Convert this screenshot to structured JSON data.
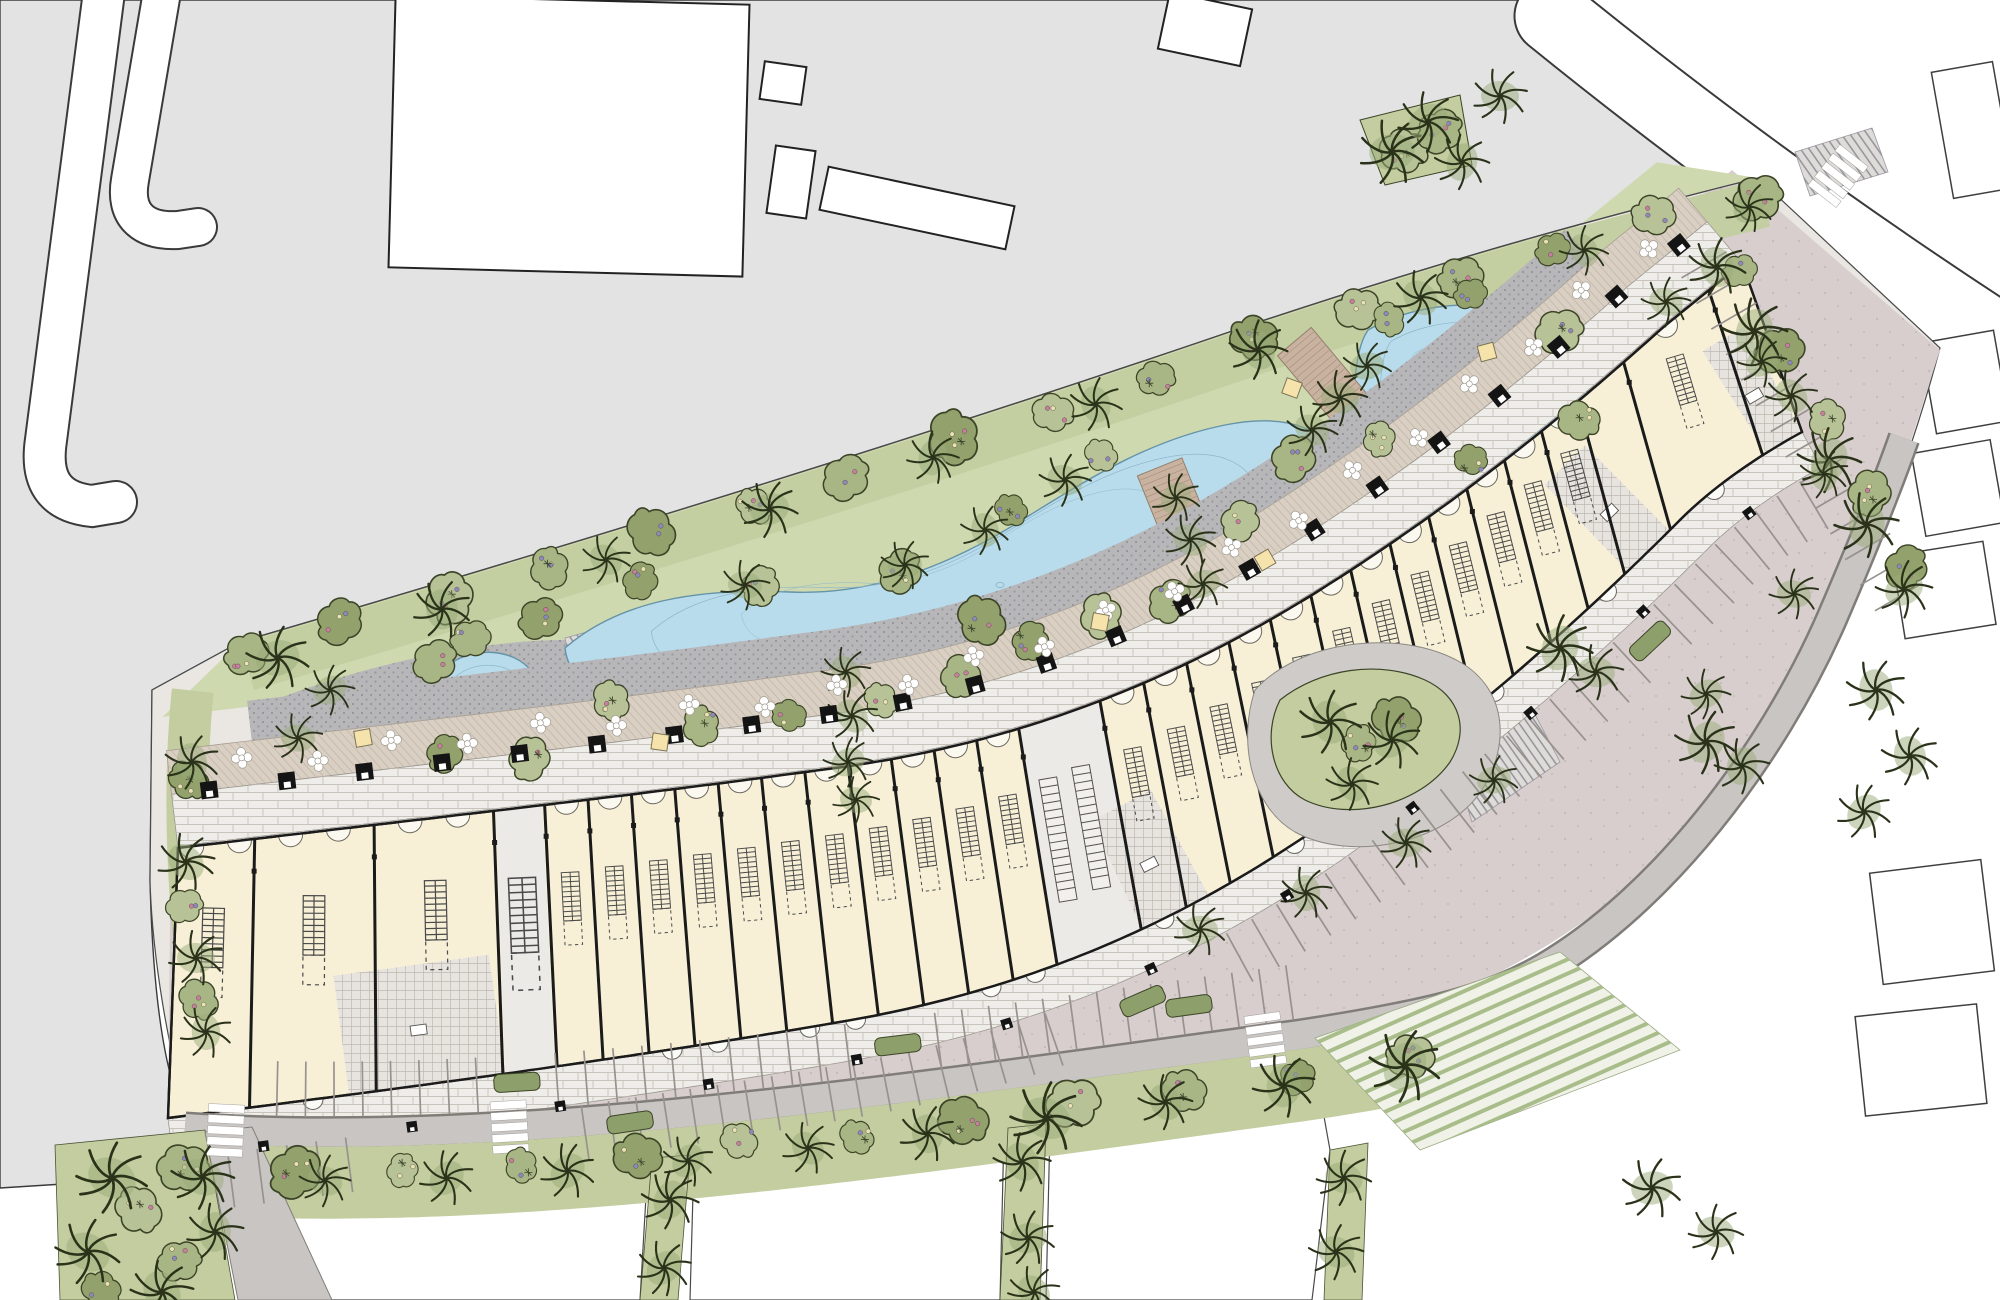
{
  "drawing": {
    "kind": "landscape-masterplan-site-plan",
    "visible_text": []
  },
  "palette": {
    "context_gray": "#e3e3e4",
    "context_stroke": "#3a3a3a",
    "site_base": "#eae7e3",
    "site_stroke": "#4a4a4a",
    "lawn": "#cfd9b0",
    "band_green": "#c2cda0",
    "strip_green": "#c3cd9f",
    "bush_greens": [
      "#a8b584",
      "#93a26d",
      "#b7c297"
    ],
    "palm_stroke": "#2a3219",
    "water": "#b8dcec",
    "water_edge": "#6593a7",
    "water_contour": "#8fb7c9",
    "playground_pink": "#e3bdb9",
    "play_stroke": "#8a8684",
    "promenade": "#efede9",
    "flower_walk": "#d9cfc3",
    "cobble": "#b7b6b8",
    "boardwalk": "#c9b3a0",
    "plank": "#927e6a",
    "building_fill": "#f7f0d7",
    "building_wall": "#1b1b1b",
    "core_fill": "#e7e4df",
    "breeze_fill": "#eceae6",
    "parking": "#d7cecd",
    "stall_line": "#98928e",
    "road_band": "#c8c5c3",
    "road_edge": "#807d79",
    "island_green": "#8da06b",
    "bench_black": "#141414",
    "seat_yellow": "#f5e3ab",
    "flower_pink": "#c77f9f",
    "flower_purple": "#8d89bd",
    "flower_cream": "#e9e2b5",
    "turf_stripe": "#a9bd8a",
    "hatch_gray": "#8f8c96"
  },
  "guides": {
    "front": "M178,848 C430,818 640,795 820,770 C1000,748 1160,690 1320,590 C1450,508 1560,420 1660,330 C1700,297 1722,280 1742,263",
    "back": "M168,1118 C430,1085 650,1055 840,1022 C1030,990 1190,920 1340,812 C1470,718 1580,620 1680,520 C1715,485 1760,455 1802,432",
    "tb": "M240,642 C520,560 900,445 1250,325 C1460,255 1610,215 1758,178",
    "bb": "M185,1128 C500,1150 900,1090 1300,1035 C1430,1015 1490,1000 1545,968 C1660,900 1770,760 1832,618 C1872,525 1892,472 1904,438",
    "wl": "M168,688 C158,780 160,920 186,1060",
    "buffer": "M1722,240 L1930,598"
  },
  "context": {
    "gray_poly": "M0,0 L1518,0 C1560,35 1640,105 1706,150 L1758,178 C1610,215 1460,255 1250,325 C900,445 520,560 240,642 L152,690 L150,880 C153,1005 166,1086 190,1126 L95,1182 L0,1188 Z",
    "roads": [
      {
        "d": "M104,-8 L46,440 C40,480 54,502 92,506 L116,502",
        "w": 40
      },
      {
        "d": "M162,-8 L130,180 C124,214 142,232 178,230 L198,227",
        "w": 36
      },
      {
        "d": "M1552,16 C1690,128 1840,238 2010,348",
        "w": 73
      }
    ],
    "buildings": [
      {
        "x": 392,
        "y": 0,
        "w": 354,
        "h": 272,
        "rot": 1.5
      },
      {
        "x": 762,
        "y": 64,
        "w": 42,
        "h": 38,
        "rot": 8
      },
      {
        "x": 771,
        "y": 148,
        "w": 40,
        "h": 68,
        "rot": 8
      },
      {
        "x": 822,
        "y": 186,
        "w": 190,
        "h": 44,
        "rot": 12
      },
      {
        "x": 1163,
        "y": 0,
        "w": 84,
        "h": 58,
        "rot": 12
      }
    ],
    "parcels": [
      {
        "x": 1942,
        "y": 66,
        "w": 62,
        "h": 128,
        "rot": -10
      },
      {
        "x": 1928,
        "y": 336,
        "w": 74,
        "h": 92,
        "rot": -10
      },
      {
        "x": 1918,
        "y": 446,
        "w": 80,
        "h": 84,
        "rot": -10
      },
      {
        "x": 1898,
        "y": 548,
        "w": 92,
        "h": 84,
        "rot": -9
      },
      {
        "x": 1876,
        "y": 866,
        "w": 112,
        "h": 112,
        "rot": -7
      },
      {
        "x": 1860,
        "y": 1010,
        "w": 122,
        "h": 100,
        "rot": -6
      }
    ],
    "bottom_parcels": [
      "M238,1192 L648,1162 L640,1300 L242,1300 Z",
      "M694,1158 L1004,1132 L1000,1300 L690,1300 Z",
      "M1050,1128 L1316,1072 L1330,1150 L1312,1300 L1046,1300 Z"
    ]
  },
  "site": {
    "base_poly": "M240,642 C520,560 900,445 1250,325 C1460,255 1610,215 1758,178 L1940,348 C1908,468 1862,588 1792,702 C1700,822 1562,940 1432,1000 C1210,1062 700,1137 190,1128 C168,1050 152,955 150,880 L152,690 Z",
    "parking_poly": "M168,1122 C500,1145 900,1088 1300,1038 C1470,1008 1598,928 1702,818 C1790,702 1862,586 1902,468 L1940,350 L1732,170 C1640,250 1540,322 1448,408 C1330,520 1190,640 1020,730 C840,812 520,862 300,880 C220,888 180,900 170,920 Z",
    "cobble_plazas": [
      "M262,705 C360,665 480,640 565,640 L605,715 C520,790 400,800 300,802 Z",
      "M1245,565 C1290,480 1380,420 1480,418 C1520,470 1515,545 1470,600 C1400,650 1300,640 1245,565 Z"
    ],
    "hatch_wedges": [
      "M565,638 L660,612 L648,692 L578,702 Z",
      "M1470,600 L1542,560 L1562,622 L1492,656 Z",
      "M1445,735 L1530,705 L1560,762 L1472,822 Z",
      "M1795,152 L1872,128 L1888,172 L1810,196 Z"
    ],
    "turf_poly": "M1315,1038 L1560,952 L1680,1050 L1420,1150 Z",
    "teardrop_ring": "M1255,690 C1300,640 1400,628 1460,662 C1505,688 1512,742 1482,790 C1445,845 1350,862 1295,832 C1250,806 1238,740 1255,690 Z",
    "teardrop_green": "M1280,700 C1320,668 1380,660 1425,680 C1460,696 1470,730 1450,762 C1420,805 1350,822 1305,800 C1272,783 1262,735 1280,700 Z",
    "median_green": "M1360,120 L1460,95 L1472,165 L1385,185 Z",
    "strip_verticals": [
      "M652,1158 L690,1155 L678,1300 L640,1300 Z",
      "M1008,1128 L1046,1124 L1040,1300 L1000,1300 Z",
      "M1330,1150 L1368,1143 L1362,1300 L1324,1300 Z"
    ],
    "corner_green": "M55,1145 L205,1130 L235,1300 L60,1300 Z",
    "corner_road": "M205,1132 L252,1127 L332,1300 L238,1300 Z"
  },
  "building": {
    "divider_segments": [
      {
        "from": 0.045,
        "to": 0.185,
        "n": 3,
        "big": true
      },
      {
        "from": 0.215,
        "to": 0.495,
        "n": 12,
        "big": false
      },
      {
        "from": 0.545,
        "to": 0.875,
        "n": 13,
        "big": false
      },
      {
        "from": 0.91,
        "to": 0.975,
        "n": 2,
        "big": false
      }
    ],
    "cores": [
      [
        0.1,
        0.185
      ],
      [
        0.545,
        0.585
      ],
      [
        0.875,
        0.91
      ],
      [
        0.975,
        1.0
      ]
    ],
    "breezeways": [
      [
        0.185,
        0.215
      ],
      [
        0.495,
        0.545
      ]
    ]
  },
  "promenade": {
    "bench_count": 22,
    "flower_count": 22,
    "south_bench_count": 12
  },
  "ponds": [
    {
      "d": "M445,668 C470,645 515,648 532,672 C548,695 545,730 528,752 C505,778 468,775 452,752 C436,730 430,690 445,668 Z",
      "bubbles": [
        [
          480,
          705,
          4
        ],
        [
          505,
          735,
          2.5
        ]
      ]
    },
    {
      "d": "M565,648 C620,600 700,588 790,592 C880,596 960,560 1030,515 C1090,478 1150,440 1225,425 C1290,412 1330,430 1345,470 C1358,505 1340,545 1300,560 C1250,578 1190,570 1130,595 C1070,620 1010,660 940,690 C860,723 760,730 680,718 C615,708 570,690 565,648 Z",
      "bubbles": [
        [
          700,
          650,
          4
        ],
        [
          850,
          655,
          3
        ],
        [
          1000,
          585,
          4
        ],
        [
          1160,
          520,
          3
        ],
        [
          1280,
          490,
          4
        ]
      ]
    },
    {
      "d": "M1368,330 C1420,300 1500,295 1555,325 C1590,345 1598,390 1575,425 C1548,462 1480,465 1425,452 C1380,442 1352,415 1355,380 C1357,358 1360,342 1368,330 Z",
      "bubbles": [
        [
          1470,
          380,
          4
        ],
        [
          1520,
          350,
          2.5
        ]
      ]
    }
  ],
  "bridges": [
    {
      "x": 851,
      "y": 737,
      "w": 52,
      "h": 178,
      "rot": 7
    },
    {
      "x": 1190,
      "y": 542,
      "w": 48,
      "h": 162,
      "rot": -22
    },
    {
      "x": 1340,
      "y": 396,
      "w": 44,
      "h": 142,
      "rot": -40
    }
  ],
  "decks": [
    {
      "x": 702,
      "y": 726,
      "w": 54,
      "h": 64,
      "rot": -16
    },
    {
      "x": 1126,
      "y": 638,
      "w": 60,
      "h": 72,
      "rot": -34
    }
  ],
  "playground": {
    "cx": 1345,
    "cy": 495,
    "rx": 100,
    "ry": 62,
    "rot": -33
  },
  "parking_rows": [
    {
      "guide": "back",
      "ranges": [
        [
          0.03,
          0.095
        ],
        [
          0.225,
          0.48
        ],
        [
          0.585,
          0.845
        ],
        [
          0.875,
          0.985
        ]
      ],
      "offset": -42,
      "depth": -55,
      "gap": 27
    },
    {
      "guide": "bb",
      "ranges": [
        [
          0.045,
          0.145
        ],
        [
          0.185,
          0.33
        ],
        [
          0.375,
          0.55
        ]
      ],
      "offset": 16,
      "depth": 55,
      "gap": 27
    },
    {
      "guide": "buffer",
      "ranges": [
        [
          0.03,
          0.96
        ]
      ],
      "offset": -2,
      "depth": -52,
      "gap": 28
    }
  ],
  "islands": [
    {
      "g": "back",
      "t": 0.25,
      "o": -66
    },
    {
      "g": "back",
      "t": 0.53,
      "o": -66
    },
    {
      "g": "back",
      "t": 0.86,
      "o": -66
    },
    {
      "g": "bb",
      "t": 0.165,
      "o": 44
    },
    {
      "g": "bb",
      "t": 0.355,
      "o": 44
    },
    {
      "g": "bb",
      "t": 0.5,
      "o": 44
    }
  ],
  "zebras": [
    {
      "g": "bb",
      "t": 0.02
    },
    {
      "g": "bb",
      "t": 0.16
    },
    {
      "g": "bb",
      "t": 0.535
    },
    {
      "x": 1838,
      "y": 176,
      "deg": 38
    }
  ],
  "palm_rows": [
    {
      "g": "tb",
      "n": 10,
      "o": -26,
      "from": 0.02,
      "to": 0.99,
      "s": 1.0
    },
    {
      "g": "bb",
      "n": 11,
      "o": -48,
      "from": 0.01,
      "to": 0.6,
      "s": 1.1
    },
    {
      "g": "buffer",
      "n": 6,
      "o": -18,
      "from": 0.05,
      "to": 0.95,
      "s": 1.05
    }
  ],
  "palms": [
    [
      846,
      672,
      0.9
    ],
    [
      852,
      716,
      0.95
    ],
    [
      848,
      762,
      0.9
    ],
    [
      856,
      800,
      0.85
    ],
    [
      1176,
      498,
      0.9
    ],
    [
      1190,
      540,
      0.95
    ],
    [
      1203,
      584,
      0.9
    ],
    [
      1312,
      430,
      0.95
    ],
    [
      1340,
      398,
      1.0
    ],
    [
      1367,
      366,
      0.9
    ],
    [
      1330,
      722,
      1.15
    ],
    [
      1392,
      740,
      1.05
    ],
    [
      1352,
      784,
      0.95
    ],
    [
      1560,
      648,
      1.2
    ],
    [
      1596,
      672,
      1.0
    ],
    [
      1706,
      742,
      1.15
    ],
    [
      1742,
      766,
      1.0
    ],
    [
      112,
      1178,
      1.3
    ],
    [
      88,
      1252,
      1.2
    ],
    [
      162,
      1292,
      1.15
    ],
    [
      215,
      1232,
      1.05
    ],
    [
      670,
      1200,
      1.05
    ],
    [
      664,
      1268,
      1.0
    ],
    [
      1022,
      1162,
      1.05
    ],
    [
      1028,
      1238,
      1.0
    ],
    [
      1034,
      1292,
      0.95
    ],
    [
      1344,
      1178,
      1.0
    ],
    [
      1336,
      1252,
      1.0
    ],
    [
      1200,
      930,
      0.95
    ],
    [
      1306,
      893,
      0.95
    ],
    [
      1406,
      843,
      0.95
    ],
    [
      1494,
      780,
      0.9
    ],
    [
      1666,
      302,
      0.9
    ],
    [
      1762,
      362,
      0.9
    ],
    [
      1824,
      474,
      0.9
    ],
    [
      1794,
      594,
      0.9
    ],
    [
      1706,
      694,
      0.9
    ],
    [
      1392,
      152,
      1.2
    ],
    [
      1428,
      122,
      1.1
    ],
    [
      1462,
      162,
      1.0
    ],
    [
      1500,
      96,
      1.0
    ],
    [
      1876,
      690,
      1.1
    ],
    [
      1910,
      756,
      1.05
    ],
    [
      1864,
      812,
      1.0
    ],
    [
      192,
      762,
      1.0
    ],
    [
      186,
      862,
      1.05
    ],
    [
      196,
      958,
      1.0
    ],
    [
      206,
      1032,
      0.95
    ],
    [
      330,
      690,
      0.9
    ],
    [
      298,
      738,
      0.9
    ],
    [
      1065,
      480,
      0.95
    ],
    [
      905,
      565,
      0.9
    ],
    [
      745,
      585,
      0.9
    ],
    [
      985,
      530,
      0.9
    ],
    [
      1652,
      1188,
      1.1
    ],
    [
      1716,
      1232,
      1.0
    ]
  ],
  "bush_rows": [
    {
      "g": "tb",
      "n": 16,
      "o": -16,
      "from": 0.0,
      "to": 1.0
    },
    {
      "g": "bb",
      "n": 12,
      "o": -38,
      "from": 0.0,
      "to": 0.6
    },
    {
      "g": "buffer",
      "n": 5,
      "o": 0,
      "from": 0.1,
      "to": 0.9
    }
  ],
  "bushes": [
    [
      470,
      640
    ],
    [
      540,
      620
    ],
    [
      610,
      700
    ],
    [
      700,
      725
    ],
    [
      790,
      715
    ],
    [
      880,
      700
    ],
    [
      960,
      675
    ],
    [
      1030,
      640
    ],
    [
      1100,
      615
    ],
    [
      1170,
      600
    ],
    [
      640,
      580
    ],
    [
      760,
      585
    ],
    [
      900,
      570
    ],
    [
      1010,
      510
    ],
    [
      1100,
      455
    ],
    [
      1390,
      320
    ],
    [
      1470,
      295
    ],
    [
      1560,
      330
    ],
    [
      1580,
      420
    ],
    [
      1470,
      460
    ],
    [
      1380,
      440
    ],
    [
      435,
      660
    ],
    [
      445,
      755
    ],
    [
      530,
      760
    ],
    [
      1358,
      742
    ],
    [
      1395,
      720
    ],
    [
      140,
      1210
    ],
    [
      180,
      1260
    ],
    [
      100,
      1290
    ],
    [
      1405,
      150
    ],
    [
      1440,
      130
    ],
    [
      190,
      780
    ],
    [
      185,
      905
    ],
    [
      200,
      1000
    ],
    [
      980,
      620
    ],
    [
      1240,
      520
    ],
    [
      1294,
      460
    ]
  ],
  "seats": [
    [
      363,
      738,
      -10
    ],
    [
      660,
      742,
      8
    ],
    [
      1265,
      560,
      -30
    ],
    [
      1292,
      388,
      20
    ],
    [
      1487,
      352,
      -15
    ],
    [
      1100,
      622,
      10
    ]
  ]
}
